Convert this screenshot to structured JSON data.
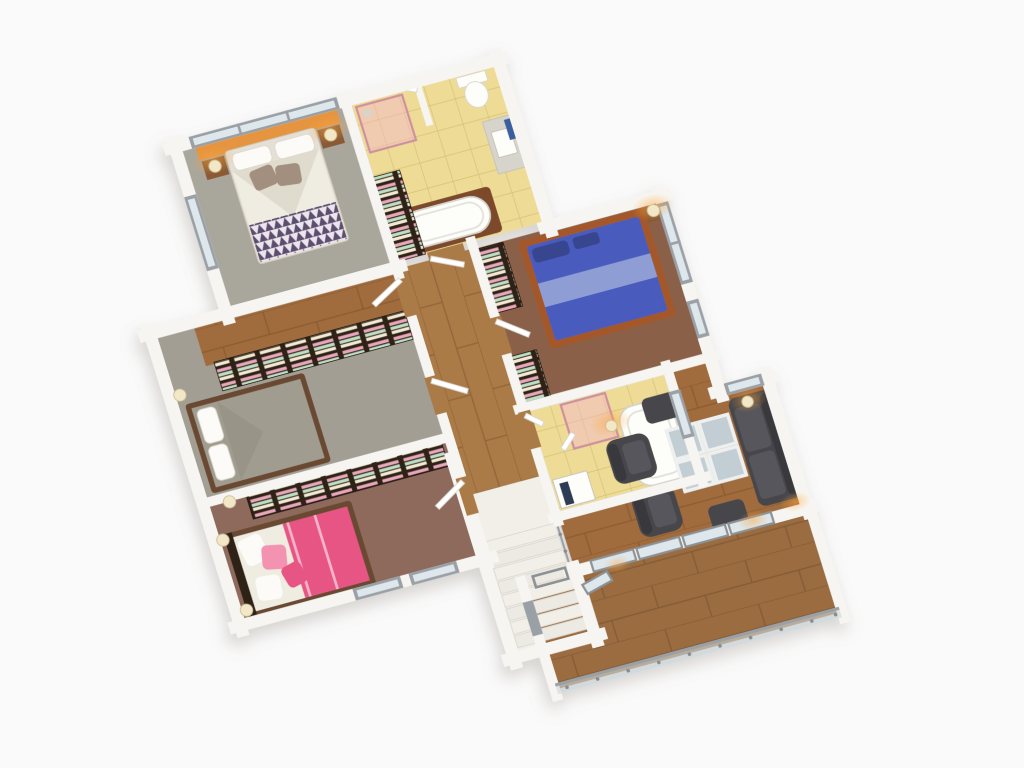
{
  "scene": {
    "kind": "3d-isometric-floor-plan-render",
    "background": "#fafafa"
  },
  "palette": {
    "background": "#fafafa",
    "wall": "#f7f5f1",
    "wall_edge": "#e3dfd8",
    "wood": "#aa7a46",
    "wood_dark": "#7e5630",
    "wood_living": "#a06c3c",
    "wood_terrace": "#9a6c40",
    "tile": "#eedc96",
    "tile_line": "#d6bf74",
    "carpet_master": "#a9a69c",
    "carpet_gray": "#a29e94",
    "carpet_brown": "#8a6148",
    "carpet_mauve": "#8e6a5d",
    "wardrobe": "#2f2014",
    "cloth_pink": "#e8a8bc",
    "cloth_mint": "#bfdfc4",
    "cloth_cream": "#f1e9d4",
    "linen": "#efece2",
    "linen_fold": "#e0dccd",
    "pillow": "#fcfbf8",
    "cushion": "#a28f80",
    "blanket": "#5f4d6e",
    "blanket_light": "#eae6ee",
    "headboard": "#e5953f",
    "bed_blue": "#4a5cbe",
    "bed_blue_dark": "#37458f",
    "runner": "#92a0d6",
    "frame_wood": "#a4582a",
    "duvet_gray": "#a09c8f",
    "frame_dark": "#6b4a33",
    "pink": "#e75584",
    "pink_light": "#f492b2",
    "sofa": "#47474b",
    "sofa_seat": "#56565b",
    "sofa_dark": "#39393d",
    "table_frame": "#eef0f0",
    "table_glass": "#c2ced3",
    "porcelain": "#fdfdfa",
    "fixture": "#d7d4cc",
    "glass_pink": "#f2bac7",
    "window_frame": "#9aa0a5",
    "window_glass": "#dde7ec",
    "lamp_glow": "#ffa53d",
    "lamp_shade": "#f2e7c6",
    "stair_floor": "#f2efe9",
    "stair_edge": "#d9d5cc",
    "railing": "#9aa0a4",
    "rail_glass": "#cdd7da",
    "towel_blue": "#3a5f9e",
    "towel_navy": "#2e3a55",
    "tub_wood": "#7c4a2a",
    "nightstand": "#8a5a34"
  },
  "rooms": [
    {
      "id": "master-bedroom"
    },
    {
      "id": "master-bathroom"
    },
    {
      "id": "bedroom-blue"
    },
    {
      "id": "bathroom-2"
    },
    {
      "id": "bedroom-gray"
    },
    {
      "id": "bedroom-pink"
    },
    {
      "id": "hallway"
    },
    {
      "id": "staircase"
    },
    {
      "id": "living-room"
    },
    {
      "id": "terrace"
    }
  ]
}
